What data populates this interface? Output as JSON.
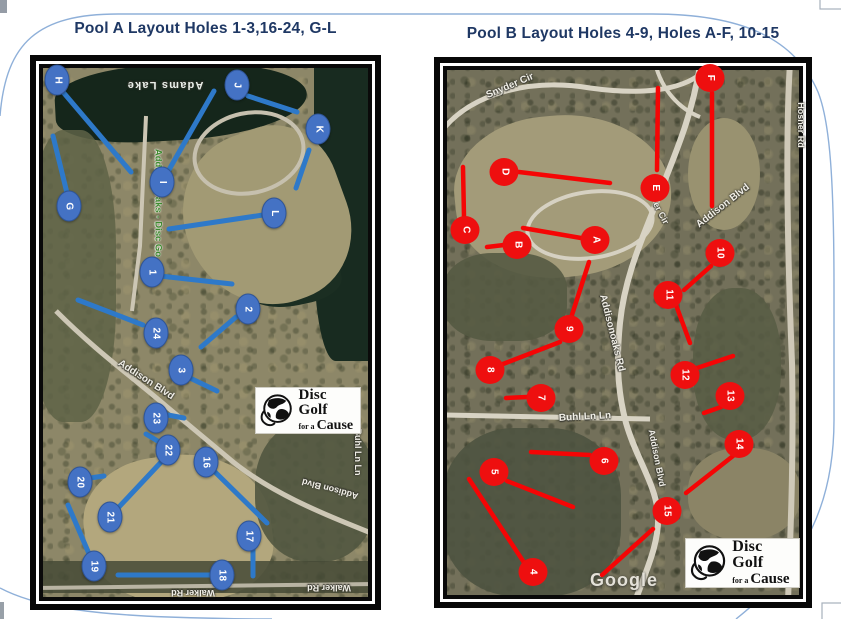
{
  "colors": {
    "title": "#1f3864",
    "pool_a_marker": "#4472c4",
    "pool_a_line": "#2e79c9",
    "pool_b_marker": "#ee0f0f",
    "pool_b_line": "#f50505"
  },
  "pool_a": {
    "title": "Pool A Layout Holes 1-3,16-24, G-L",
    "marker_color": "#4472c4",
    "line_color": "#2e79c9",
    "markers": [
      {
        "label": "H",
        "x": 57,
        "y": 80
      },
      {
        "label": "J",
        "x": 237,
        "y": 85
      },
      {
        "label": "K",
        "x": 318,
        "y": 129
      },
      {
        "label": "I",
        "x": 162,
        "y": 182
      },
      {
        "label": "G",
        "x": 69,
        "y": 206
      },
      {
        "label": "L",
        "x": 274,
        "y": 213
      },
      {
        "label": "1",
        "x": 152,
        "y": 272
      },
      {
        "label": "2",
        "x": 248,
        "y": 309
      },
      {
        "label": "24",
        "x": 156,
        "y": 333
      },
      {
        "label": "3",
        "x": 181,
        "y": 370
      },
      {
        "label": "23",
        "x": 156,
        "y": 418
      },
      {
        "label": "22",
        "x": 168,
        "y": 450
      },
      {
        "label": "16",
        "x": 206,
        "y": 462
      },
      {
        "label": "20",
        "x": 80,
        "y": 482
      },
      {
        "label": "21",
        "x": 110,
        "y": 517
      },
      {
        "label": "17",
        "x": 249,
        "y": 536
      },
      {
        "label": "19",
        "x": 94,
        "y": 566
      },
      {
        "label": "18",
        "x": 222,
        "y": 575
      }
    ],
    "lines": [
      [
        63,
        92,
        131,
        172
      ],
      [
        53,
        136,
        67,
        193
      ],
      [
        166,
        175,
        214,
        91
      ],
      [
        248,
        96,
        297,
        112
      ],
      [
        309,
        150,
        296,
        188
      ],
      [
        263,
        215,
        169,
        229
      ],
      [
        160,
        276,
        232,
        284
      ],
      [
        236,
        317,
        201,
        347
      ],
      [
        78,
        300,
        143,
        325
      ],
      [
        190,
        378,
        217,
        391
      ],
      [
        168,
        415,
        184,
        418
      ],
      [
        146,
        434,
        161,
        443
      ],
      [
        118,
        508,
        164,
        459
      ],
      [
        213,
        470,
        267,
        523
      ],
      [
        90,
        478,
        104,
        476
      ],
      [
        68,
        505,
        90,
        556
      ],
      [
        253,
        548,
        253,
        576
      ],
      [
        118,
        575,
        211,
        575
      ]
    ],
    "road_labels": [
      {
        "text": "Adams Lake",
        "x": 165,
        "y": 85,
        "rot": 180,
        "kind": "lake"
      },
      {
        "text": "Addison Oaks - Disc Go",
        "x": 158,
        "y": 203,
        "rot": 90,
        "kind": "park"
      },
      {
        "text": "Addison Blvd",
        "x": 146,
        "y": 380,
        "rot": 33,
        "kind": "big"
      },
      {
        "text": "Buhl Ln Ln",
        "x": 358,
        "y": 452,
        "rot": 90
      },
      {
        "text": "Addison Blvd",
        "x": 330,
        "y": 489,
        "rot": 195
      },
      {
        "text": "Walker Rd",
        "x": 193,
        "y": 593,
        "rot": 180
      },
      {
        "text": "Walker Rd",
        "x": 329,
        "y": 588,
        "rot": 180
      }
    ]
  },
  "pool_b": {
    "title": "Pool B Layout Holes 4-9, Holes A-F, 10-15",
    "marker_color": "#ee0f0f",
    "line_color": "#f50505",
    "watermark": "Google",
    "markers": [
      {
        "label": "F",
        "x": 710,
        "y": 78
      },
      {
        "label": "D",
        "x": 504,
        "y": 172
      },
      {
        "label": "E",
        "x": 655,
        "y": 188
      },
      {
        "label": "C",
        "x": 465,
        "y": 230
      },
      {
        "label": "B",
        "x": 517,
        "y": 245
      },
      {
        "label": "A",
        "x": 595,
        "y": 240
      },
      {
        "label": "10",
        "x": 720,
        "y": 253
      },
      {
        "label": "11",
        "x": 668,
        "y": 295
      },
      {
        "label": "9",
        "x": 569,
        "y": 329
      },
      {
        "label": "8",
        "x": 490,
        "y": 370
      },
      {
        "label": "12",
        "x": 685,
        "y": 375
      },
      {
        "label": "13",
        "x": 730,
        "y": 396
      },
      {
        "label": "7",
        "x": 541,
        "y": 398
      },
      {
        "label": "14",
        "x": 739,
        "y": 444
      },
      {
        "label": "6",
        "x": 604,
        "y": 461
      },
      {
        "label": "5",
        "x": 494,
        "y": 472
      },
      {
        "label": "15",
        "x": 667,
        "y": 511
      },
      {
        "label": "4",
        "x": 533,
        "y": 572
      }
    ],
    "lines": [
      [
        712,
        93,
        712,
        206
      ],
      [
        658,
        88,
        657,
        170
      ],
      [
        519,
        172,
        610,
        183
      ],
      [
        463,
        167,
        464,
        217
      ],
      [
        487,
        247,
        504,
        245
      ],
      [
        523,
        228,
        581,
        238
      ],
      [
        589,
        262,
        570,
        321
      ],
      [
        711,
        266,
        684,
        290
      ],
      [
        676,
        305,
        690,
        343
      ],
      [
        560,
        342,
        503,
        364
      ],
      [
        697,
        368,
        733,
        356
      ],
      [
        721,
        407,
        704,
        413
      ],
      [
        506,
        398,
        527,
        397
      ],
      [
        733,
        456,
        686,
        493
      ],
      [
        590,
        455,
        531,
        452
      ],
      [
        507,
        481,
        573,
        507
      ],
      [
        469,
        479,
        525,
        564
      ],
      [
        653,
        529,
        602,
        575
      ]
    ],
    "road_labels": [
      {
        "text": "Snyder Cir",
        "x": 510,
        "y": 86,
        "rot": -23,
        "kind": "big"
      },
      {
        "text": "Hosner Rd",
        "x": 801,
        "y": 125,
        "rot": 90
      },
      {
        "text": "Addison Blvd",
        "x": 723,
        "y": 206,
        "rot": -38,
        "kind": "big"
      },
      {
        "text": "er Cir",
        "x": 661,
        "y": 213,
        "rot": 62
      },
      {
        "text": "Addisonoaks Rd",
        "x": 612,
        "y": 333,
        "rot": 76,
        "kind": "big"
      },
      {
        "text": "Buhl Ln Ln",
        "x": 585,
        "y": 417,
        "rot": -3,
        "kind": "big"
      },
      {
        "text": "Addison Blvd",
        "x": 657,
        "y": 458,
        "rot": 79
      }
    ]
  },
  "logo": {
    "line1": "Disc Golf",
    "line2_small": "for a",
    "line2_big": "Cause"
  }
}
